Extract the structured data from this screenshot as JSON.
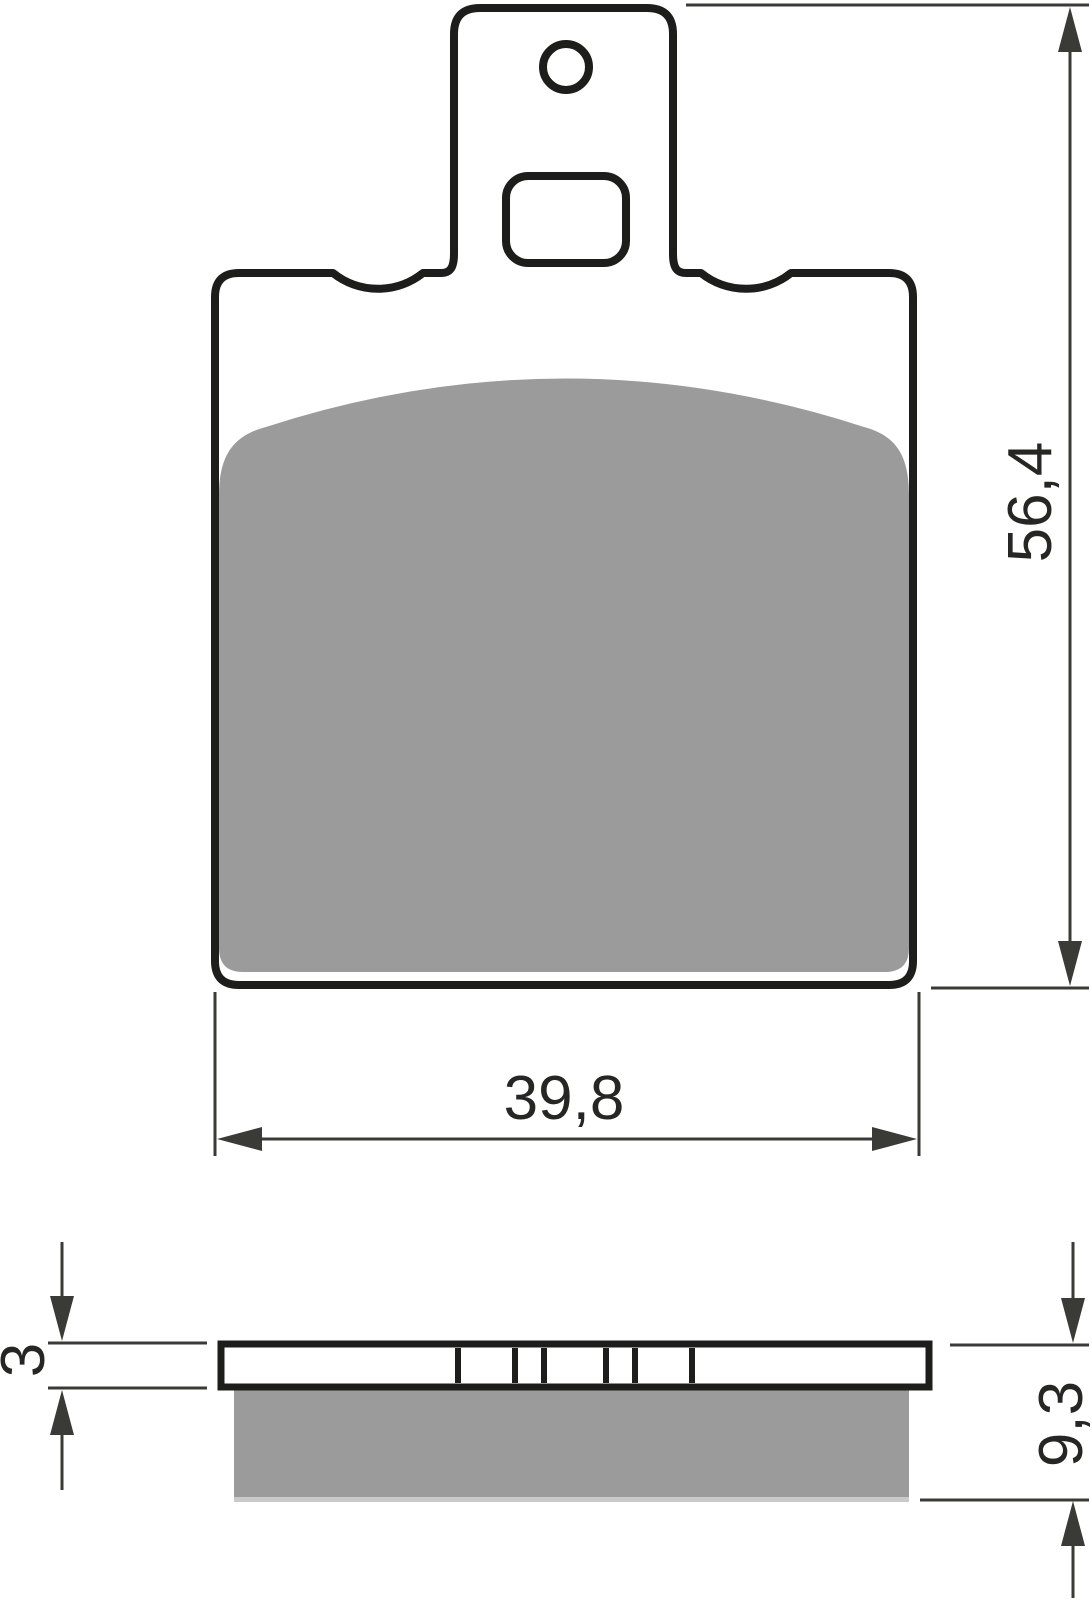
{
  "dimensions": {
    "height": "56,4",
    "width": "39,8",
    "plate_thickness": "3",
    "total_thickness": "9,3"
  },
  "colors": {
    "outline": "#1d1d1b",
    "friction": "#9b9b9b",
    "friction_edge": "#c9c9c9",
    "dimension": "#3a3a36"
  }
}
